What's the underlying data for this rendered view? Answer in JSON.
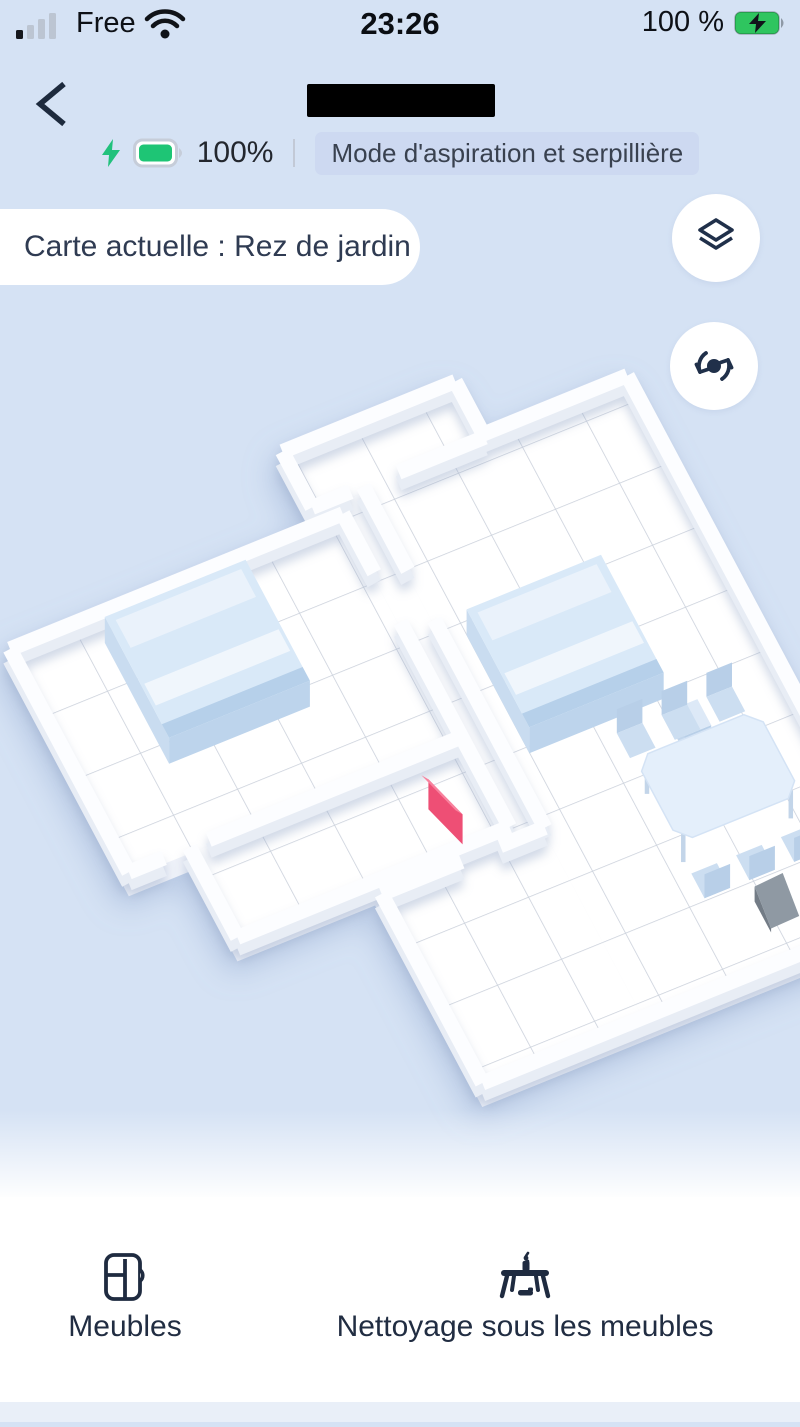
{
  "status_bar": {
    "signal_icon": "cellular-signal-1-of-4",
    "carrier": "Free",
    "wifi_icon": "wifi",
    "time": "23:26",
    "battery_text": "100 %",
    "battery_icon": "battery-full-charging"
  },
  "header": {
    "back_icon": "chevron-left",
    "battery_level": "100%",
    "charging_icon": "lightning-bolt",
    "mode_badge": "Mode d'aspiration et serpillière"
  },
  "map": {
    "current_map_label": "Carte actuelle : Rez de jardin",
    "buttons": [
      {
        "icon": "map-layers"
      },
      {
        "icon": "rotate-map"
      }
    ],
    "objects": [
      "bed-1",
      "bed-2",
      "nightstand",
      "dining-table",
      "chairs",
      "charging-dock",
      "virtual-wall-marker"
    ]
  },
  "bottom_bar": {
    "items": [
      {
        "icon": "furniture",
        "label": "Meubles"
      },
      {
        "icon": "clean-under-furniture",
        "label": "Nettoyage sous les meubles"
      }
    ]
  },
  "colors": {
    "background": "#d5e2f4",
    "accent_dark": "#1f2c44",
    "battery_green": "#2fc55f",
    "badge_bg": "#cdd9f1",
    "map_floor": "#ffffff",
    "furniture_blue": "#d9e9f8",
    "virtual_wall_pink": "#ee4f74",
    "dock_gray": "#8f99a3"
  }
}
